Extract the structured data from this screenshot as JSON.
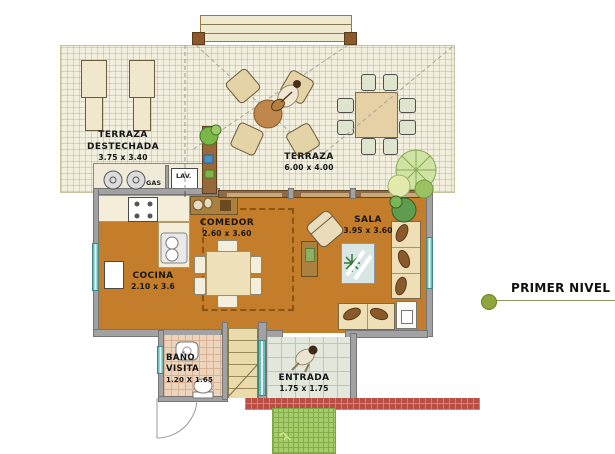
{
  "legend": {
    "label": "PRIMER NIVEL",
    "dot_color": "#8da53b"
  },
  "rooms": {
    "terraza_destechada": {
      "line1": "TERRAZA",
      "line2": "DESTECHADA",
      "dims": "3.75 x 3.40"
    },
    "terraza": {
      "name": "TERRAZA",
      "dims": "6.00 x 4.00"
    },
    "cocina": {
      "name": "COCINA",
      "dims": "2.10 x 3.6"
    },
    "comedor": {
      "name": "COMEDOR",
      "dims": "2.60 x 3.60"
    },
    "sala": {
      "name": "SALA",
      "dims": "3.95 x 3.60"
    },
    "bano_visita": {
      "line1": "BAÑO",
      "line2": "VISITA",
      "dims": "1.20 X 1.65"
    },
    "entrada": {
      "name": "ENTRADA",
      "dims": "1.75 x 1.75"
    }
  },
  "labels": {
    "gas": "GAS",
    "lav": "LAV."
  },
  "colors": {
    "interior_floor": "#c47d2b",
    "terraza_floor": "#f2efde",
    "wall_gray": "#a2a2a2",
    "sliding_wall_brown": "#8d6b46",
    "window_teal": "#6fb9b7",
    "grass_green": "#a6cd6d",
    "path_red": "#b94f44",
    "bano_tile": "#edd5bd",
    "legend_dot_olive": "#8da53b"
  },
  "furniture_icons": [
    "sun-lounger-icon",
    "round-table-icon",
    "patio-chair-icon",
    "dining-table-icon",
    "sofa-icon",
    "loveseat-icon",
    "armchair-icon",
    "coffee-table-icon",
    "stove-icon",
    "sink-icon",
    "fridge-icon",
    "gas-cylinder-icon",
    "toilet-icon",
    "stairs-icon",
    "plant-icon",
    "person-icon"
  ]
}
